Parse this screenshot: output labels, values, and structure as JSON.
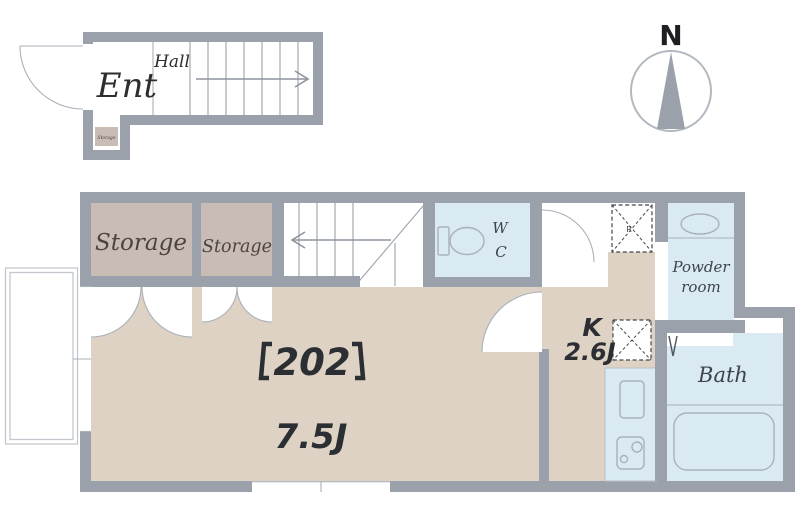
{
  "colors": {
    "wall": "#9aa1ab",
    "floor": "#ddd2c3",
    "storage": "#c9bcb5",
    "wet": "#d9eaf2",
    "line": "#a9b1b9",
    "ink": "#2b2e33",
    "roomtext": "#4b443f"
  },
  "entrance": {
    "room_label": "Ent",
    "hall_label": "Hall",
    "storage_label": "Storage"
  },
  "compass": {
    "north_label": "N"
  },
  "plan": {
    "storage1_label": "Storage",
    "storage2_label": "Storage",
    "wc_label_line1": "W",
    "wc_label_line2": "C",
    "fridge_mark": "R",
    "powder_label_line1": "Powder",
    "powder_label_line2": "room",
    "bath_label": "Bath",
    "kitchen_label": "K",
    "kitchen_size": "2.6J",
    "unit_label": "【202】",
    "unit_number": "202",
    "main_size": "7.5J"
  }
}
